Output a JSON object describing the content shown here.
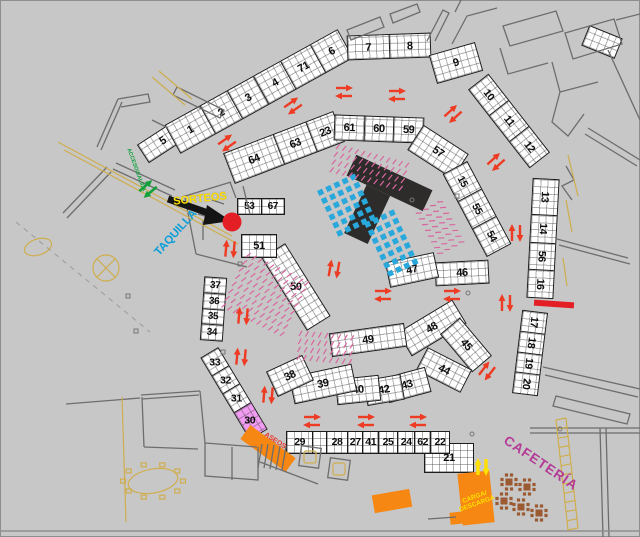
{
  "legend_labels": {
    "sorteos": "SORTEOS",
    "taquilla": "TAQUILLA",
    "acceso_salida": "ACCESO/SALIDA",
    "aseos": "ASEOS",
    "cafeteria": "CAFETERÍA",
    "carga_line1": "CARGA/",
    "carga_line2": "DESCARGA"
  },
  "colors": {
    "background": "#c7c7c7",
    "stall_fill": "#ffffff",
    "stall_border": "#1c1c1c",
    "flow_arrow_red": "#ee3b23",
    "entry_arrow_green": "#12a13b",
    "loading_arrow_yellow": "#ffe000",
    "sorteos_text": "#ffe000",
    "taquilla_text": "#0b9ed9",
    "acceso_text": "#12a13b",
    "aseos_text": "#e8372b",
    "cafeteria_text": "#b43a96",
    "carga_text": "#ffe000",
    "orange_zone": "#f68712",
    "pink_stall": "#f29bf2",
    "seat_dot_blue": "#29a8dc",
    "stage_black": "#2e2b2b",
    "hatch_pink": "#d9679f",
    "marker_red": "#e31e24",
    "table_brown": "#9c5a33",
    "cad_gray": "#6d6d6d",
    "cad_tan": "#cfae4e"
  },
  "strips": [
    {
      "id": "s5",
      "labels": [
        "5"
      ]
    },
    {
      "id": "s1_6",
      "labels": [
        "1",
        "2",
        "3",
        "4",
        "71",
        "6"
      ]
    },
    {
      "id": "s7_8",
      "labels": [
        "7",
        "8"
      ]
    },
    {
      "id": "s9",
      "labels": [
        "9"
      ]
    },
    {
      "id": "s10_12",
      "labels": [
        "10",
        "11",
        "12"
      ]
    },
    {
      "id": "s13_16",
      "labels": [
        "13",
        "14",
        "56",
        "16"
      ]
    },
    {
      "id": "s17_20",
      "labels": [
        "17",
        "18",
        "19",
        "20"
      ]
    },
    {
      "id": "s21",
      "labels": [
        "21"
      ]
    },
    {
      "id": "srow",
      "labels": [
        "29",
        "28",
        "27",
        "41",
        "25",
        "24",
        "62",
        "22"
      ]
    },
    {
      "id": "s33_30",
      "labels": [
        "33",
        "32",
        "31",
        "30"
      ]
    },
    {
      "id": "s37_34",
      "labels": [
        "37",
        "36",
        "35",
        "34"
      ]
    },
    {
      "id": "s64_23",
      "labels": [
        "64",
        "63",
        "23"
      ]
    },
    {
      "id": "s61_59",
      "labels": [
        "61",
        "60",
        "59"
      ]
    },
    {
      "id": "s57",
      "labels": [
        "57"
      ]
    },
    {
      "id": "s15_54",
      "labels": [
        "15",
        "55",
        "54"
      ]
    },
    {
      "id": "s46",
      "labels": [
        "46"
      ]
    },
    {
      "id": "s47",
      "labels": [
        "47"
      ]
    },
    {
      "id": "s48",
      "labels": [
        "48"
      ]
    },
    {
      "id": "s45",
      "labels": [
        "45"
      ]
    },
    {
      "id": "s44",
      "labels": [
        "44"
      ]
    },
    {
      "id": "s43",
      "labels": [
        "43"
      ]
    },
    {
      "id": "s42",
      "labels": [
        "42"
      ]
    },
    {
      "id": "s40",
      "labels": [
        "40"
      ]
    },
    {
      "id": "s39",
      "labels": [
        "39"
      ]
    },
    {
      "id": "s38",
      "labels": [
        "38"
      ]
    },
    {
      "id": "s49",
      "labels": [
        "49"
      ]
    },
    {
      "id": "s50",
      "labels": [
        "50"
      ]
    },
    {
      "id": "s51",
      "labels": [
        "51"
      ]
    },
    {
      "id": "s53_67",
      "labels": [
        "53",
        "67"
      ]
    }
  ]
}
